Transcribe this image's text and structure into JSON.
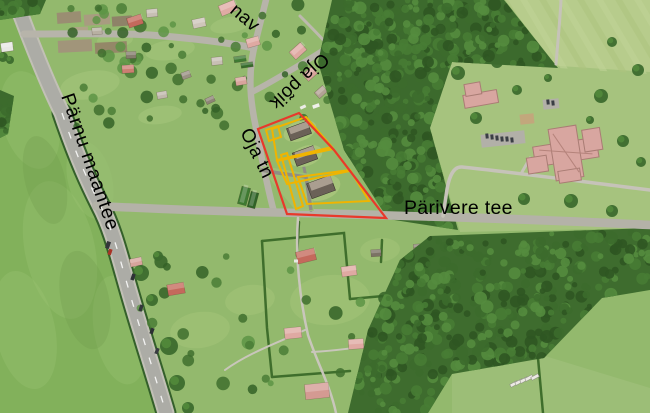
{
  "map": {
    "width": 650,
    "height": 413,
    "base_color": "#93b96d",
    "street_labels": [
      {
        "name": "parnu-maantee",
        "text": "Pärnu maantee",
        "x": 61,
        "y": 96,
        "rotate": 71,
        "font_size": 19.5,
        "letter_spacing": 0.8
      },
      {
        "name": "parivere-tee",
        "text": "Pärivere tee",
        "x": 404,
        "y": 214,
        "rotate": 0,
        "font_size": 19.5,
        "letter_spacing": 0.3
      },
      {
        "name": "oja-poik",
        "text": "Oja põik",
        "x": 322,
        "y": 52,
        "rotate": 137,
        "font_size": 19,
        "letter_spacing": 0.4
      },
      {
        "name": "oja-tn",
        "text": "Oja tn",
        "x": 240,
        "y": 132,
        "rotate": 64,
        "font_size": 19,
        "letter_spacing": 0.4
      },
      {
        "name": "street-partial",
        "text": "nav",
        "x": 229,
        "y": 12,
        "rotate": 40,
        "font_size": 19,
        "letter_spacing": 0.4
      }
    ],
    "cadastre": {
      "boundary_color": "#e8392b",
      "parcel_color": "#f0b400",
      "boundary_points": "258,129 299,113 334,150 386,218 287,214",
      "parcels": [
        {
          "name": "plot-square",
          "points": "266,130 278,126 281,137 269,141"
        },
        {
          "name": "plot-top",
          "points": "272,129 306,117 332,147 277,160"
        },
        {
          "name": "plot-middle",
          "points": "277,161 333,149 350,171 287,184"
        },
        {
          "name": "plot-bottom",
          "points": "298,177 350,170 369,201 307,204"
        },
        {
          "name": "plot-strip",
          "points": "281,155 287,153 303,206 296,209"
        }
      ]
    },
    "fields": [
      {
        "name": "left-field",
        "points": "0,0 10,0 62,113 100,205 122,240 168,413 0,413",
        "fill": "#82b15b"
      },
      {
        "name": "topright-field",
        "points": "505,0 650,0 650,74 558,68",
        "fill": "#b7cc8c"
      },
      {
        "name": "school-lawn",
        "points": "452,60 560,66 650,72 650,228 460,232 430,128",
        "fill": "#a6c37e"
      },
      {
        "name": "bottomright-lawn",
        "points": "452,372 545,356 650,388 650,413 452,413",
        "fill": "#9cbe77"
      }
    ],
    "forests": [
      {
        "name": "central-forest",
        "points": "332,0 504,0 558,68 452,62 430,128 458,230 388,219 344,150 318,62",
        "fill": "#3c6a2d",
        "count": 430,
        "seed": 7
      },
      {
        "name": "bottomright-forest",
        "points": "430,236 650,228 650,290 602,298 544,358 452,374 428,413 348,413 368,330 400,260",
        "fill": "#3e6c2e",
        "count": 400,
        "seed": 13
      },
      {
        "name": "topleft-corner-trees",
        "points": "0,0 46,0 40,14 0,20",
        "fill": "#3c6a2d",
        "count": 20,
        "seed": 21
      },
      {
        "name": "left-edge-trees",
        "points": "0,90 14,96 8,134 0,138",
        "fill": "#3c6a2d",
        "count": 14,
        "seed": 29
      }
    ],
    "roads": [
      {
        "name": "highway-hedge",
        "d": "M62,113 C 78,160 90,185 100,205 C 112,228 118,252 126,280 C 140,330 155,375 166,413",
        "width": 21,
        "color": "#34602a"
      },
      {
        "name": "highway-shoulder",
        "d": "M13,-6 C 30,40 48,85 62,113 C 78,160 90,185 100,205 C 112,228 118,252 126,280 C 140,330 155,375 166,413",
        "width": 17,
        "color": "#c2c0b6"
      },
      {
        "name": "highway",
        "d": "M13,-6 C 30,40 48,85 62,113 C 78,160 90,185 100,205 C 112,228 118,252 126,280 C 140,330 155,375 166,413",
        "width": 13,
        "color": "#acaca6"
      },
      {
        "name": "village-road",
        "d": "M24,34 C 70,34 120,33 150,35 C 190,38 225,42 254,48",
        "width": 7,
        "color": "#b7b4aa"
      },
      {
        "name": "tanav-road",
        "d": "M254,48 C 258,32 262,16 266,0",
        "width": 6.5,
        "color": "#b7b4aa"
      },
      {
        "name": "oja-tn-road",
        "d": "M254,48 C 248,75 250,100 256,128 C 262,160 268,190 274,212",
        "width": 6.5,
        "color": "#b7b4aa"
      },
      {
        "name": "oja-poik-road",
        "d": "M252,92 C 280,78 315,55 344,38",
        "width": 6,
        "color": "#b7b4aa"
      },
      {
        "name": "forest-edge-path",
        "d": "M300,16 C 318,34 336,52 348,72 C 352,82 354,90 355,98",
        "width": 3,
        "color": "#bdb9ae"
      },
      {
        "name": "parivere-tee-road",
        "d": "M96,206 C 180,210 240,212 300,213 C 400,215 520,218 650,225",
        "width": 8.5,
        "color": "#b4b2a8"
      },
      {
        "name": "summer-lane",
        "d": "M298,218 C 295,255 300,300 308,335 C 318,365 330,385 336,413",
        "width": 2.5,
        "color": "#c9c6bb"
      },
      {
        "name": "summer-branch-w",
        "d": "M305,330 C 280,342 250,352 225,370",
        "width": 2,
        "color": "#c9c6bb"
      },
      {
        "name": "summer-branch-e",
        "d": "M312,352 C 350,350 390,342 428,338",
        "width": 2,
        "color": "#c9c6bb"
      }
    ],
    "roads_over": [
      {
        "name": "parivere-tee-east",
        "d": "M330,214 C 420,216 520,219 650,225",
        "width": 8.5,
        "color": "#b4b2a8"
      },
      {
        "name": "school-path",
        "d": "M650,190 C 570,180 510,172 462,167 C 452,166 448,180 446,196 L 443,216",
        "width": 3.5,
        "color": "#c6c3b9"
      },
      {
        "name": "school-path-north",
        "d": "M556,64 C 558,40 560,20 561,0",
        "width": 3,
        "color": "#c6c3b9"
      },
      {
        "name": "school-entry",
        "d": "M522,172 L 530,158",
        "width": 3,
        "color": "#c6c3b9"
      },
      {
        "name": "driveway",
        "d": "M262,170 C 280,174 295,175 306,177 L 311,210",
        "width": 3.5,
        "color": "#8f8d85"
      },
      {
        "name": "driveway-spur",
        "d": "M306,177 L 301,154",
        "width": 3,
        "color": "#8f8d85"
      }
    ],
    "highway_dashes": {
      "d": "M62,113 C 78,160 90,185 100,205 C 112,228 118,252 126,280 C 140,330 155,375 166,413",
      "color": "#ffffff",
      "width": 1.3,
      "dash": "7 13"
    },
    "topright_stripes": {
      "count": 8,
      "x0": 500,
      "step": 19,
      "dx": 52,
      "colors": [
        "#adc47f",
        "#c2d498"
      ],
      "width": 6,
      "opacity": 0.55
    },
    "plots": [
      [
        57,
        12,
        24,
        11,
        -4,
        "#9a8e72"
      ],
      [
        84,
        14,
        26,
        11,
        -4,
        "#a89c80"
      ],
      [
        112,
        16,
        20,
        10,
        -4,
        "#8e8268"
      ],
      [
        58,
        40,
        34,
        12,
        -3,
        "#a1957a"
      ],
      [
        95,
        42,
        32,
        11,
        -3,
        "#948868"
      ],
      [
        70,
        27,
        18,
        8,
        -3,
        "#b0a488"
      ]
    ],
    "hedges": [
      {
        "d": "M262,241 L344,233 L350,299"
      },
      {
        "d": "M262,241 L267,328 L272,377"
      },
      {
        "d": "M350,299 L429,292"
      },
      {
        "d": "M429,238 L429,292"
      },
      {
        "d": "M272,377 L350,371"
      },
      {
        "d": "M299,222 L297,256"
      },
      {
        "d": "M538,358 L543,413"
      },
      {
        "d": "M382,240 L381,262"
      }
    ],
    "buildings": {
      "village": [
        [
          135,
          21,
          15,
          10,
          -18,
          "#c4695c"
        ],
        [
          152,
          13,
          11,
          8,
          -5,
          "#c7bfb4"
        ],
        [
          97,
          31,
          10,
          7,
          -5,
          "#b8b0a2"
        ],
        [
          199,
          23,
          13,
          9,
          -12,
          "#cfc6ba"
        ],
        [
          228,
          8,
          17,
          11,
          -22,
          "#e0aba4"
        ],
        [
          253,
          42,
          13,
          9,
          -16,
          "#dfa9a2"
        ],
        [
          298,
          51,
          15,
          10,
          -42,
          "#dfa9a2"
        ],
        [
          310,
          74,
          12,
          9,
          -42,
          "#d8a49c"
        ],
        [
          321,
          92,
          11,
          8,
          -42,
          "#b2a294"
        ],
        [
          241,
          81,
          11,
          8,
          -10,
          "#d8a49c"
        ],
        [
          217,
          61,
          11,
          8,
          -6,
          "#c7bfb4"
        ],
        [
          128,
          69,
          12,
          8,
          -4,
          "#cc7f72"
        ],
        [
          131,
          55,
          10,
          7,
          -2,
          "#857d6e"
        ],
        [
          186,
          75,
          9,
          7,
          -20,
          "#9a9184"
        ],
        [
          162,
          95,
          10,
          7,
          -10,
          "#c0b8ac"
        ],
        [
          210,
          100,
          9,
          6,
          -25,
          "#8d8476"
        ],
        [
          240,
          59,
          12,
          6,
          -8,
          "#3f7a33"
        ],
        [
          247,
          65,
          12,
          5,
          -8,
          "#356c2b"
        ],
        [
          244,
          196,
          18,
          9,
          -75,
          "#3e7a31"
        ],
        [
          253,
          200,
          16,
          8,
          -75,
          "#2f6327"
        ],
        [
          7,
          47,
          12,
          9,
          -8,
          "#e8e8e4"
        ]
      ],
      "parcel": [
        [
          299,
          131,
          22,
          13,
          -20
        ],
        [
          305,
          156,
          22,
          14,
          -20
        ],
        [
          321,
          187,
          25,
          16,
          -20
        ]
      ],
      "summer": [
        [
          176,
          289,
          17,
          11,
          -10,
          "#c4695c"
        ],
        [
          306,
          256,
          19,
          12,
          -14,
          "#c4695c"
        ],
        [
          349,
          271,
          15,
          10,
          -8,
          "#dfa9a2"
        ],
        [
          376,
          253,
          10,
          7,
          -4,
          "#7b7365"
        ],
        [
          293,
          333,
          17,
          11,
          -6,
          "#dfa9a2"
        ],
        [
          356,
          344,
          15,
          10,
          -4,
          "#dfa9a2"
        ],
        [
          399,
          373,
          17,
          11,
          -8,
          "#d8a09a"
        ],
        [
          317,
          391,
          24,
          15,
          -6,
          "#d49a92"
        ],
        [
          363,
          404,
          15,
          10,
          -2,
          "#dfa9a2"
        ],
        [
          136,
          262,
          12,
          8,
          -12,
          "#d8a49c"
        ],
        [
          418,
          247,
          9,
          6,
          -4,
          "#8d8476"
        ]
      ],
      "school": {
        "fill": "#d8a6a0",
        "stroke": "#a97c74",
        "rotate": -9,
        "cx": 566,
        "cy": 153,
        "rects": [
          [
            566,
            152,
            64,
            20
          ],
          [
            566,
            153,
            28,
            52
          ],
          [
            536,
            160,
            20,
            16
          ],
          [
            594,
            144,
            18,
            22
          ],
          [
            566,
            176,
            22,
            12
          ]
        ],
        "seams": [
          [
            540,
            146,
            592,
            158
          ],
          [
            556,
            132,
            576,
            174
          ]
        ],
        "annex": {
          "rotate": -10,
          "cx": 480,
          "cy": 95,
          "rects": [
            [
              480,
              99,
              34,
              13
            ],
            [
              474,
              88,
              16,
              12
            ]
          ]
        },
        "court": [
          527,
          119,
          14,
          10,
          -6,
          "#c2a77c"
        ],
        "parking": [
          [
            503,
            139,
            44,
            13,
            -6
          ],
          [
            551,
            104,
            16,
            10,
            -6
          ]
        ],
        "cars": [
          [
            487,
            136
          ],
          [
            492,
            137
          ],
          [
            497,
            138
          ],
          [
            502,
            139
          ],
          [
            507,
            139
          ],
          [
            512,
            140
          ],
          [
            548,
            102
          ],
          [
            553,
            103
          ]
        ]
      },
      "trailers": [
        [
          514,
          384
        ],
        [
          519,
          382
        ],
        [
          524,
          380
        ],
        [
          529,
          378
        ],
        [
          535,
          377
        ]
      ]
    },
    "vehicles": [
      [
        108,
        245,
        4,
        7,
        18,
        "#34363a"
      ],
      [
        110,
        252,
        3.5,
        6,
        18,
        "#a83326"
      ],
      [
        133,
        277,
        3.5,
        6.5,
        18,
        "#2e3236"
      ],
      [
        141,
        308,
        3.5,
        6.5,
        19,
        "#33373b"
      ],
      [
        152,
        331,
        3.5,
        6,
        20,
        "#2c2f33"
      ],
      [
        157,
        351,
        3.5,
        6,
        20,
        "#383c40"
      ],
      [
        296,
        261,
        4,
        3,
        0,
        "#e8e8e2"
      ],
      [
        316,
        106,
        7,
        3.5,
        -20,
        "#f0f0ea"
      ],
      [
        303,
        107,
        6,
        3,
        -25,
        "#edece6"
      ]
    ],
    "trees": {
      "palette": [
        "#4a7c36",
        "#5d9445",
        "#3f6e2e",
        "#346127"
      ],
      "singles": [
        [
          458,
          73,
          7
        ],
        [
          497,
          62,
          6
        ],
        [
          476,
          118,
          6
        ],
        [
          517,
          90,
          5
        ],
        [
          601,
          96,
          7
        ],
        [
          623,
          141,
          6
        ],
        [
          638,
          70,
          6
        ],
        [
          612,
          42,
          5
        ],
        [
          524,
          199,
          6
        ],
        [
          571,
          201,
          7
        ],
        [
          612,
          211,
          6
        ],
        [
          641,
          162,
          5
        ],
        [
          590,
          120,
          4
        ],
        [
          548,
          78,
          4
        ],
        [
          141,
          273,
          8
        ],
        [
          152,
          300,
          6
        ],
        [
          169,
          346,
          9
        ],
        [
          177,
          383,
          8
        ],
        [
          158,
          256,
          5
        ],
        [
          188,
          408,
          6
        ],
        [
          3,
          57,
          5
        ],
        [
          10,
          60,
          4
        ]
      ],
      "scatter_regions": [
        {
          "points": "58,2 330,2 330,126 60,126",
          "count": 60,
          "seed": 41,
          "rmin": 2.5,
          "rmax": 6.5
        },
        {
          "points": "122,224 428,224 428,392 122,392",
          "count": 34,
          "seed": 55,
          "rmin": 3,
          "rmax": 7
        }
      ]
    },
    "patches": {
      "left_field_light": [
        [
          30,
          120,
          28,
          50,
          -15
        ],
        [
          60,
          250,
          35,
          70,
          -12
        ],
        [
          25,
          330,
          30,
          60,
          -12
        ],
        [
          90,
          180,
          22,
          40,
          -15
        ],
        [
          120,
          330,
          26,
          55,
          -10
        ]
      ],
      "left_field_dark": [
        [
          45,
          180,
          20,
          45,
          -14
        ],
        [
          85,
          300,
          24,
          50,
          -12
        ]
      ],
      "village_lawn": [
        [
          90,
          85,
          30,
          14,
          -10
        ],
        [
          170,
          50,
          25,
          10,
          -8
        ],
        [
          230,
          25,
          20,
          8,
          -10
        ],
        [
          160,
          115,
          22,
          9,
          -8
        ],
        [
          115,
          40,
          18,
          8,
          -5
        ]
      ],
      "summer_lawn": [
        [
          330,
          300,
          40,
          25,
          -5
        ],
        [
          250,
          300,
          25,
          15,
          -8
        ],
        [
          380,
          250,
          20,
          12,
          -5
        ],
        [
          200,
          330,
          30,
          18,
          -8
        ],
        [
          390,
          390,
          22,
          12,
          -4
        ]
      ],
      "clearings": [
        [
          300,
          131,
          17,
          10,
          -20
        ],
        [
          306,
          156,
          17,
          10,
          -20
        ],
        [
          322,
          188,
          19,
          12,
          -20
        ]
      ],
      "clearing_strip": "262,166 310,174 314,211 296,211 272,182"
    }
  }
}
